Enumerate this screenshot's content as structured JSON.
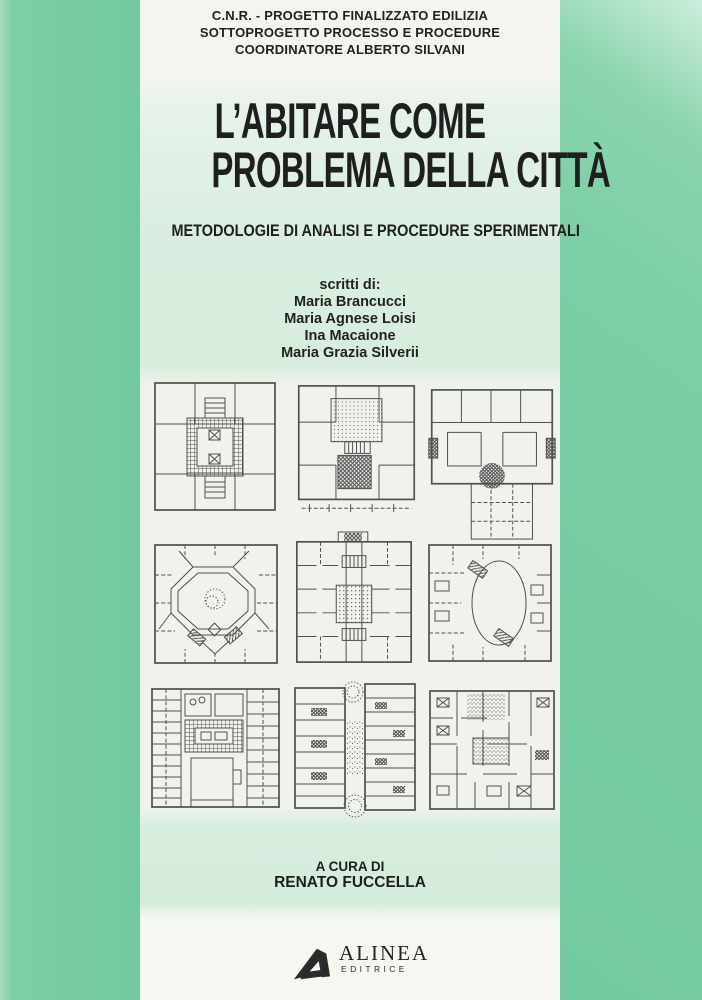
{
  "cover": {
    "header": {
      "lines": [
        "C.N.R. - PROGETTO FINALIZZATO EDILIZIA",
        "SOTTOPROGETTO PROCESSO E PROCEDURE",
        "COORDINATORE ALBERTO SILVANI"
      ]
    },
    "title": {
      "line1": "L’ABITARE COME",
      "line2": "PROBLEMA DELLA CITTÀ",
      "subtitle": "METODOLOGIE DI ANALISI E PROCEDURE SPERIMENTALI"
    },
    "authors": {
      "label": "scritti di:",
      "names": [
        "Maria Brancucci",
        "Maria Agnese Loisi",
        "Ina Macaione",
        "Maria Grazia Silverii"
      ]
    },
    "plans": [
      {
        "name": "floor-plan-square-gridded-central-court"
      },
      {
        "name": "floor-plan-square-two-central-blocks"
      },
      {
        "name": "floor-plan-wide-block-lower-courtyard"
      },
      {
        "name": "floor-plan-octagonal-court"
      },
      {
        "name": "floor-plan-central-corridor-spine"
      },
      {
        "name": "floor-plan-oval-court"
      },
      {
        "name": "floor-plan-dense-wings-two-courts"
      },
      {
        "name": "floor-plan-double-wing-with-trees"
      },
      {
        "name": "floor-plan-dense-room-grid"
      }
    ],
    "editor": {
      "line1": "A CURA DI",
      "line2": "RENATO FUCCELLA"
    },
    "publisher": {
      "logo": "alinea-a-logo",
      "name": "ALINEA",
      "tagline": "EDITRICE"
    },
    "colors": {
      "side_green": "#79cda4",
      "panel_green": "#d9eee0",
      "paper": "#f2f5ee",
      "ink": "#1d1d1d",
      "plan_ink": "#3a3a3a"
    }
  }
}
